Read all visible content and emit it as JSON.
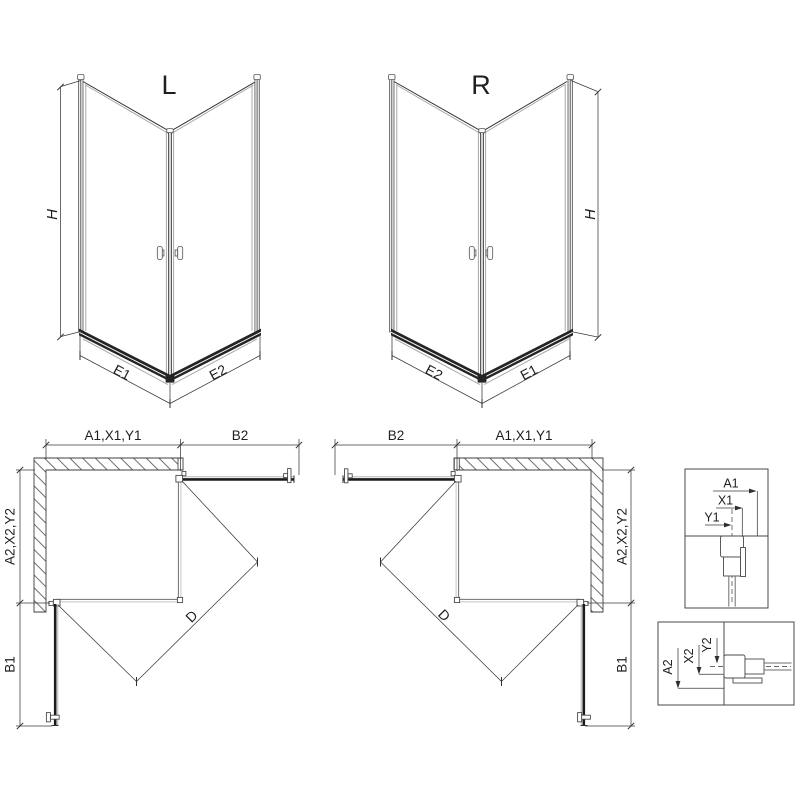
{
  "diagram": {
    "iso_left": {
      "variant": "L",
      "h": "H",
      "e1": "E1",
      "e2": "E2"
    },
    "iso_right": {
      "variant": "R",
      "h": "H",
      "e1": "E1",
      "e2": "E2"
    },
    "plan_left": {
      "top_width": "A1,X1,Y1",
      "door_top": "B2",
      "side_depth": "A2,X2,Y2",
      "door_side": "B1",
      "diagonal": "D"
    },
    "plan_right": {
      "top_width": "A1,X1,Y1",
      "door_top": "B2",
      "side_depth": "A2,X2,Y2",
      "door_side": "B1",
      "diagonal": "D"
    },
    "detail_top": {
      "a1": "A1",
      "x1": "X1",
      "y1": "Y1"
    },
    "detail_bottom": {
      "a2": "A2",
      "x2": "X2",
      "y2": "Y2"
    },
    "colors": {
      "line": "#2e2e2e",
      "glass": "#a8a8a8",
      "profile_dark": "#242424",
      "background": "#ffffff"
    }
  }
}
